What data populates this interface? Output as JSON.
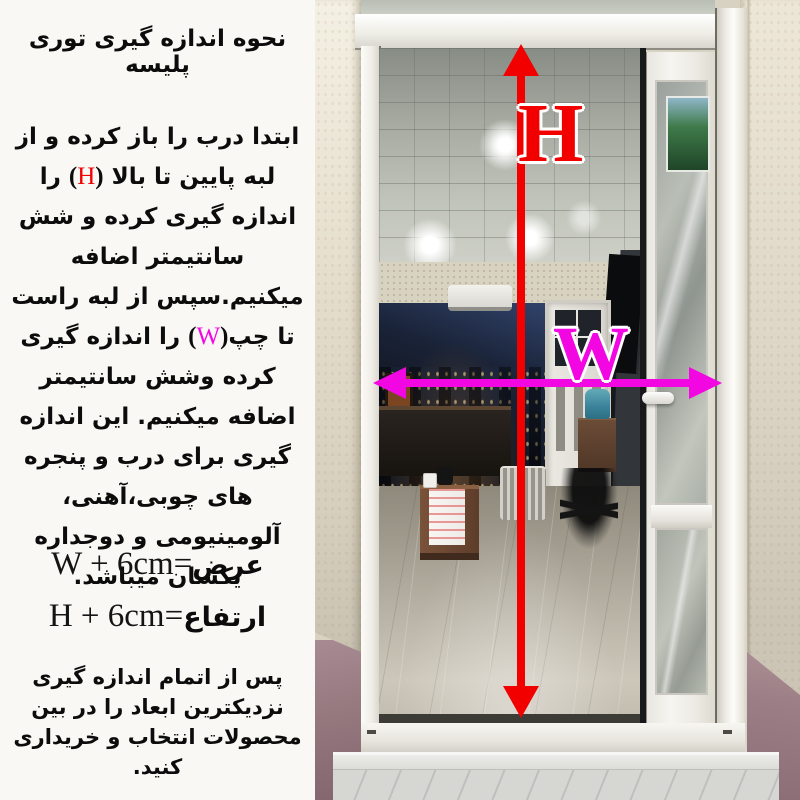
{
  "instructions": {
    "title": "نحوه اندازه گیری توری پلیسه",
    "para_part1": "ابتدا درب را باز کرده و از لبه پایین تا بالا ",
    "paren_open": "(",
    "paren_close": ")",
    "h_letter": "H",
    "para_part2": " را اندازه گیری کرده و شش سانتیمتر اضافه میکنیم.سپس از لبه راست تا چپ",
    "w_letter": "W",
    "para_part3": " را اندازه گیری کرده وشش سانتیمتر اضافه میکنیم. این اندازه گیری برای درب و پنجره های چوبی،آهنی، آلومینیومی و دوجداره یکسان میباشد.",
    "footer_note": "پس از اتمام اندازه گیری نزدیکترین ابعاد را در بین محصولات انتخاب و خریداری کنید."
  },
  "formulas": {
    "width": {
      "label": "عرض",
      "equals": "=",
      "expression": "W + 6cm"
    },
    "height": {
      "label": "ارتفاع",
      "equals": "=",
      "expression": "H + 6cm"
    }
  },
  "photo": {
    "height_label": "H",
    "width_label": "W",
    "height_arrow_color": "#f20000",
    "width_arrow_color": "#f207e2",
    "height_label_color": "#f20000",
    "width_label_color": "#e426d8"
  }
}
